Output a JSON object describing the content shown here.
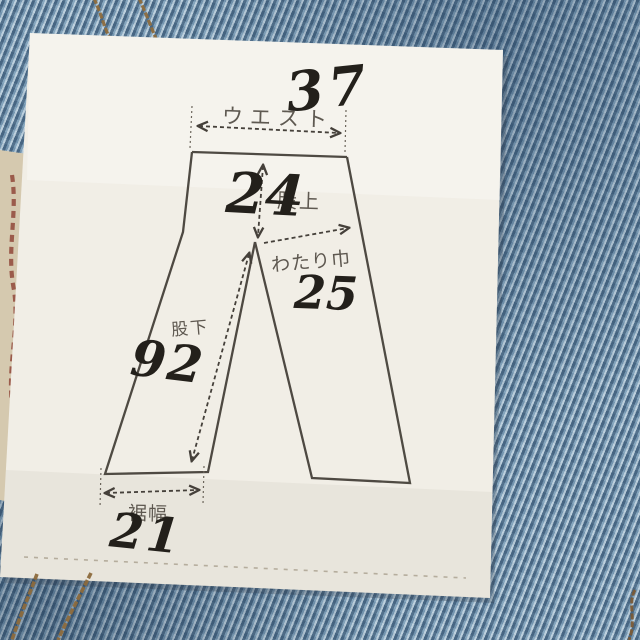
{
  "sheet": {
    "waist": {
      "label": "ウエスト",
      "value": "37"
    },
    "rise": {
      "label": "股上",
      "value": "24"
    },
    "thigh": {
      "label": "わたり巾",
      "value": "25"
    },
    "inseam": {
      "label": "股下",
      "value": "92"
    },
    "hem": {
      "label": "裾幅",
      "value": "21"
    }
  },
  "colors": {
    "denim": "#7499b3",
    "paper": "#f1eee6",
    "printed_ink": "#3d3831",
    "handwritten_ink": "#23201b",
    "stitch_thread": "#8d6b3d",
    "tag_base": "#d5c9af",
    "tag_text": "#87362a"
  }
}
